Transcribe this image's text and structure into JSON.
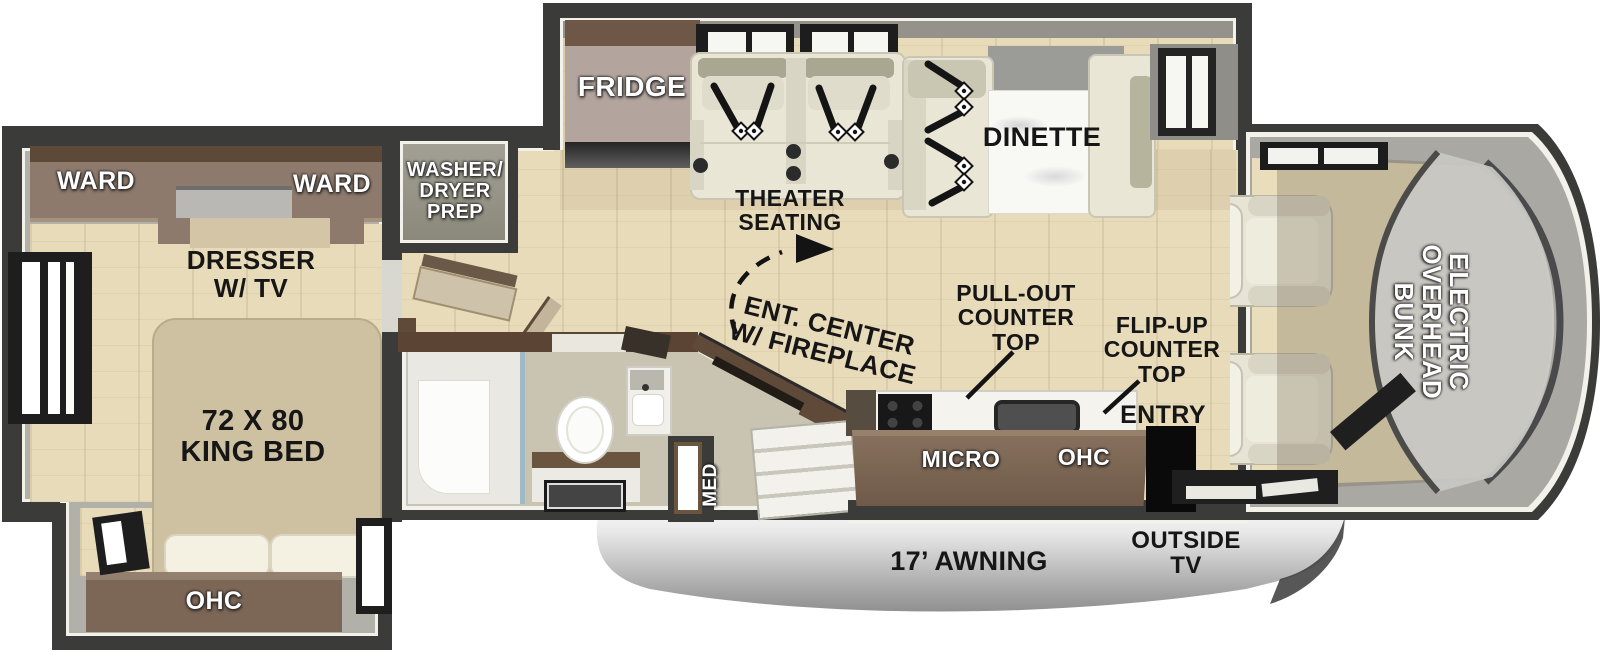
{
  "labels": {
    "ward_left": "WARD",
    "ward_right": "WARD",
    "dresser_tv": "DRESSER\nW/ TV",
    "king_bed": "72 X 80\nKING BED",
    "bedroom_ohc": "OHC",
    "washer_dryer_prep": "WASHER/\nDRYER\nPREP",
    "fridge": "FRIDGE",
    "theater_seating": "THEATER\nSEATING",
    "dinette": "DINETTE",
    "ent_center": "ENT. CENTER\nW/ FIREPLACE",
    "pull_out_counter": "PULL-OUT\nCOUNTER\nTOP",
    "flip_up_counter": "FLIP-UP\nCOUNTER\nTOP",
    "entry": "ENTRY",
    "micro": "MICRO",
    "kitchen_ohc": "OHC",
    "med": "MED",
    "awning": "17’ AWNING",
    "outside_tv": "OUTSIDE\nTV",
    "overhead_bunk": "ELECTRIC\nOVERHEAD\nBUNK"
  },
  "colors": {
    "wall": "#3b3b39",
    "floor_wood": "#e8dbba",
    "cabinet_brown": "#7c6656",
    "cabinet_dark": "#5f4a3a",
    "seat_cream": "#e9e6d6",
    "trim_white": "#f2f1ea",
    "awning_silver": "#c2c2c2",
    "label_black": "#161616",
    "label_white": "#ffffff"
  }
}
